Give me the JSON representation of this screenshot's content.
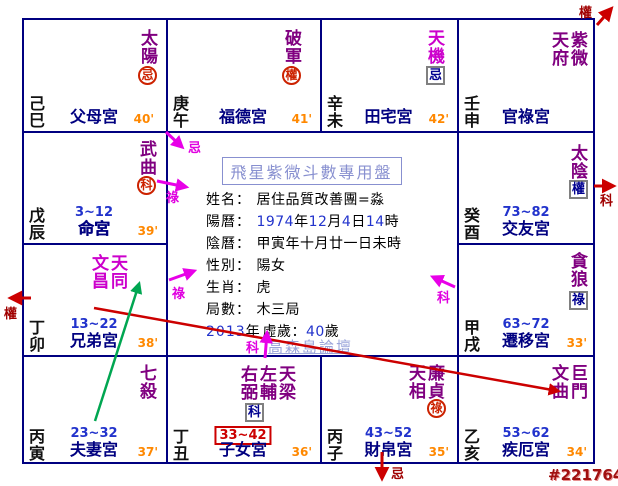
{
  "colors": {
    "star": "#800080",
    "star_alt": "#cc00cc",
    "accent_red": "#cc0000",
    "accent_magenta": "#e800e8",
    "accent_green": "#00a651",
    "border_navy": "#000080",
    "time_orange": "#ff8800",
    "range_blue": "#2233cc"
  },
  "center": {
    "title": "飛星紫微斗數專用盤",
    "watermark": "高森島論壇",
    "fields": [
      {
        "label": "姓名：",
        "value": "居住品質改善團=淼"
      },
      {
        "label": "陽曆：",
        "value": "1974年12月4日14時"
      },
      {
        "label": "陰曆：",
        "value": "甲寅年十月廿一日未時"
      },
      {
        "label": "性別：",
        "value": "陽女"
      },
      {
        "label": "生肖：",
        "value": "虎"
      },
      {
        "label": "局數：",
        "value": "木三局"
      },
      {
        "label": "2013年",
        "value": "虛歲：40歲"
      }
    ]
  },
  "cells": [
    {
      "branch": "己巳",
      "stars": "太陽",
      "mark": "忌",
      "palace": "父母宮",
      "time": "40'",
      "range": ""
    },
    {
      "branch": "庚午",
      "stars": "破軍",
      "mark": "權",
      "palace": "福德宮",
      "time": "41'",
      "range": ""
    },
    {
      "branch": "辛未",
      "stars": "天機",
      "mark": "忌",
      "palace": "田宅宮",
      "time": "42'",
      "range": ""
    },
    {
      "branch": "壬申",
      "stars": "紫微天府",
      "mark": "",
      "palace": "官祿宮",
      "time": "",
      "range": ""
    },
    {
      "branch": "戊辰",
      "stars": "武曲",
      "mark": "科",
      "palace": "命宮",
      "time": "39'",
      "range": "3~12"
    },
    {
      "branch": "癸酉",
      "stars": "太陰",
      "mark": "權",
      "palace": "交友宮",
      "time": "",
      "range": "73~82"
    },
    {
      "branch": "丁卯",
      "stars": "天同文昌",
      "mark": "",
      "palace": "兄弟宮",
      "time": "38'",
      "range": "13~22"
    },
    {
      "branch": "甲戌",
      "stars": "貪狼",
      "mark": "祿",
      "palace": "遷移宮",
      "time": "33'",
      "range": "63~72"
    },
    {
      "branch": "丙寅",
      "stars": "七殺",
      "mark": "",
      "palace": "夫妻宮",
      "time": "37'",
      "range": "23~32"
    },
    {
      "branch": "丁丑",
      "stars": "天梁左輔右弼",
      "mark": "科",
      "palace": "子女宮",
      "time": "36'",
      "range": "33~42"
    },
    {
      "branch": "丙子",
      "stars": "廉貞天相",
      "mark": "祿",
      "palace": "財帛宮",
      "time": "35'",
      "range": "43~52"
    },
    {
      "branch": "乙亥",
      "stars": "巨門文曲",
      "mark": "",
      "palace": "疾厄宮",
      "time": "34'",
      "range": "53~62"
    }
  ],
  "arrows": {
    "top_right_out": "權",
    "right_mid_out": "科",
    "left_out": "權",
    "bottom_out": "忌",
    "center_ji": "忌",
    "center_lu_upper": "祿",
    "center_lu_lower": "祿",
    "center_ke_right": "科",
    "center_ke_bottom": "科"
  },
  "footer": {
    "id_tag": "#2217641"
  }
}
